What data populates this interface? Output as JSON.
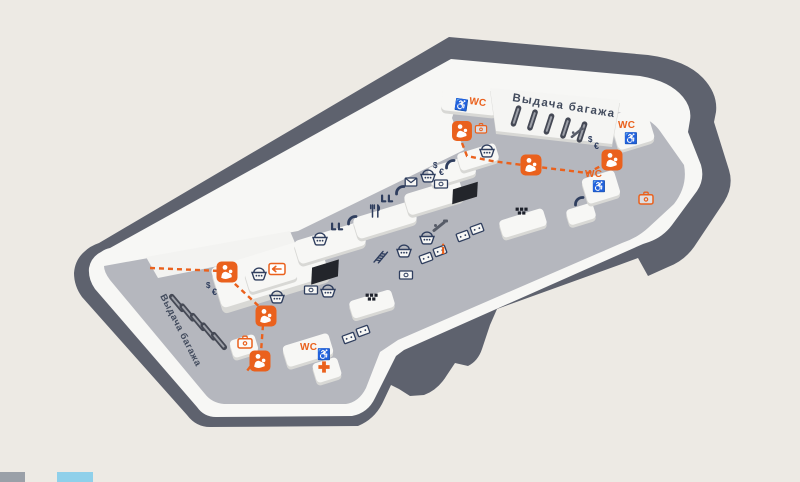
{
  "map": {
    "labels": {
      "baggage_claim_upper": "Выдача багажа",
      "baggage_claim_lower": "Выдача багажа",
      "wc": "WC",
      "info": "i"
    },
    "icon_glyphs": {
      "wheelchair": "♿",
      "dollar": "$",
      "euro": "€"
    },
    "colors": {
      "background": "#edeae4",
      "outer_band": "#5e626e",
      "platform_white": "#f7f7f5",
      "floor_gray": "#b5b7be",
      "carousel_dark": "#454955",
      "display_dark": "#23252b",
      "icon_navy": "#2f3e5e",
      "accent_orange": "#ea611d",
      "route_orange": "#ea611d",
      "footer_button_gray": "#9aa0a8",
      "footer_button_blue": "#8fd0ea"
    },
    "route": {
      "style": "dashed",
      "color": "#ea611d"
    },
    "amenities": [
      "baggage-carousel",
      "toilets",
      "accessible-toilet",
      "mother-and-child-room",
      "currency-exchange",
      "atm",
      "shop",
      "cafe",
      "payphone",
      "post",
      "left-luggage",
      "information",
      "taxi",
      "ticket-kiosk",
      "seating",
      "stairs",
      "escalator",
      "medical-aid",
      "exit",
      "flight-info-display"
    ]
  },
  "footer": {
    "buttons": [
      {
        "id": "floor-button-1",
        "color": "#9aa0a8"
      },
      {
        "id": "floor-button-2",
        "color": "#8fd0ea"
      }
    ]
  }
}
